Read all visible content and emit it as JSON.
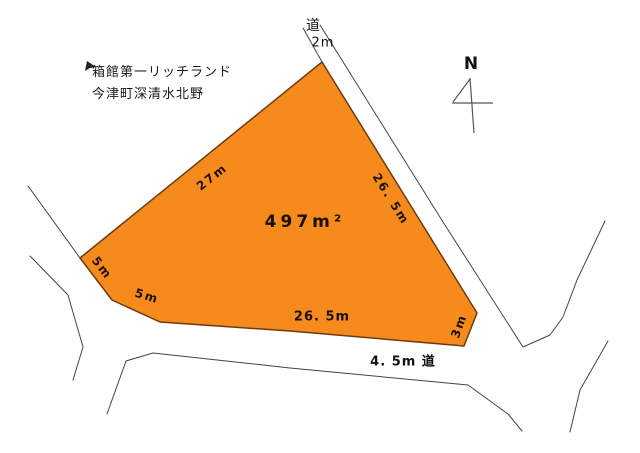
{
  "title": {
    "line1": "箱館第一リッチランド",
    "line2": "今津町深清水北野"
  },
  "compass": {
    "north_label": "N"
  },
  "parcel": {
    "area_label": "497m²"
  },
  "roads": {
    "top": {
      "name": "道",
      "width": "2m"
    },
    "bottom": {
      "label": "4. 5m 道"
    }
  },
  "dimensions": {
    "northwest_edge": "27m",
    "east_edge": "26. 5m",
    "west_upper_edge": "5m",
    "west_lower_edge": "5m",
    "south_edge": "26. 5m",
    "southeast_edge": "3m"
  },
  "colors": {
    "background": "#ffffff",
    "parcel_fill": "#F78A1C",
    "parcel_border": "#6A3C10",
    "road_line": "#444444",
    "label_text": "#1a1006"
  }
}
